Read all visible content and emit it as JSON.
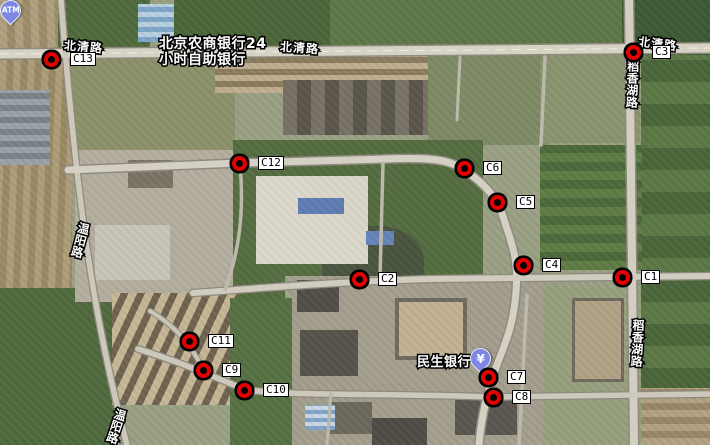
{
  "map": {
    "view": "satellite",
    "marker_label_offset_x": 19,
    "markers": [
      {
        "id": "C1",
        "x": 622,
        "y": 277
      },
      {
        "id": "C2",
        "x": 359,
        "y": 279
      },
      {
        "id": "C3",
        "x": 633,
        "y": 52
      },
      {
        "id": "C4",
        "x": 523,
        "y": 265
      },
      {
        "id": "C5",
        "x": 497,
        "y": 202
      },
      {
        "id": "C6",
        "x": 464,
        "y": 168
      },
      {
        "id": "C7",
        "x": 488,
        "y": 377
      },
      {
        "id": "C8",
        "x": 493,
        "y": 397
      },
      {
        "id": "C9",
        "x": 203,
        "y": 370
      },
      {
        "id": "C10",
        "x": 244,
        "y": 390
      },
      {
        "id": "C11",
        "x": 189,
        "y": 341
      },
      {
        "id": "C12",
        "x": 239,
        "y": 163
      },
      {
        "id": "C13",
        "x": 51,
        "y": 59
      }
    ],
    "road_labels": [
      {
        "text": "北清路",
        "x": 64,
        "y": 41,
        "vertical": false,
        "rot": 5
      },
      {
        "text": "北清路",
        "x": 280,
        "y": 42,
        "vertical": false,
        "rot": 4
      },
      {
        "text": "北清路",
        "x": 638,
        "y": 38,
        "vertical": false,
        "rot": 7
      },
      {
        "text": "稻香湖路",
        "x": 626,
        "y": 60,
        "vertical": true,
        "rot": 2
      },
      {
        "text": "稻香湖路",
        "x": 631,
        "y": 319,
        "vertical": true,
        "rot": 3
      },
      {
        "text": "温阳路",
        "x": 74,
        "y": 222,
        "vertical": true,
        "rot": 15
      },
      {
        "text": "温阳路",
        "x": 110,
        "y": 408,
        "vertical": true,
        "rot": 18
      }
    ],
    "pois": [
      {
        "name": "北京农商银行24小时自助银行",
        "line1": "北京农商银行24",
        "line2": "小时自助银行",
        "icon": "atm-pin",
        "icon_text": "ATM"
      },
      {
        "name": "民生银行",
        "line1": "民生银行",
        "line2": "",
        "icon": "bank-pin",
        "icon_text": "¥"
      }
    ],
    "colors": {
      "marker_ring": "#e60000",
      "marker_core": "#000000",
      "marker_label_bg": "#ffffff",
      "pin_fill": "#7e88e2",
      "road_fill": "#d3cfc2"
    }
  }
}
